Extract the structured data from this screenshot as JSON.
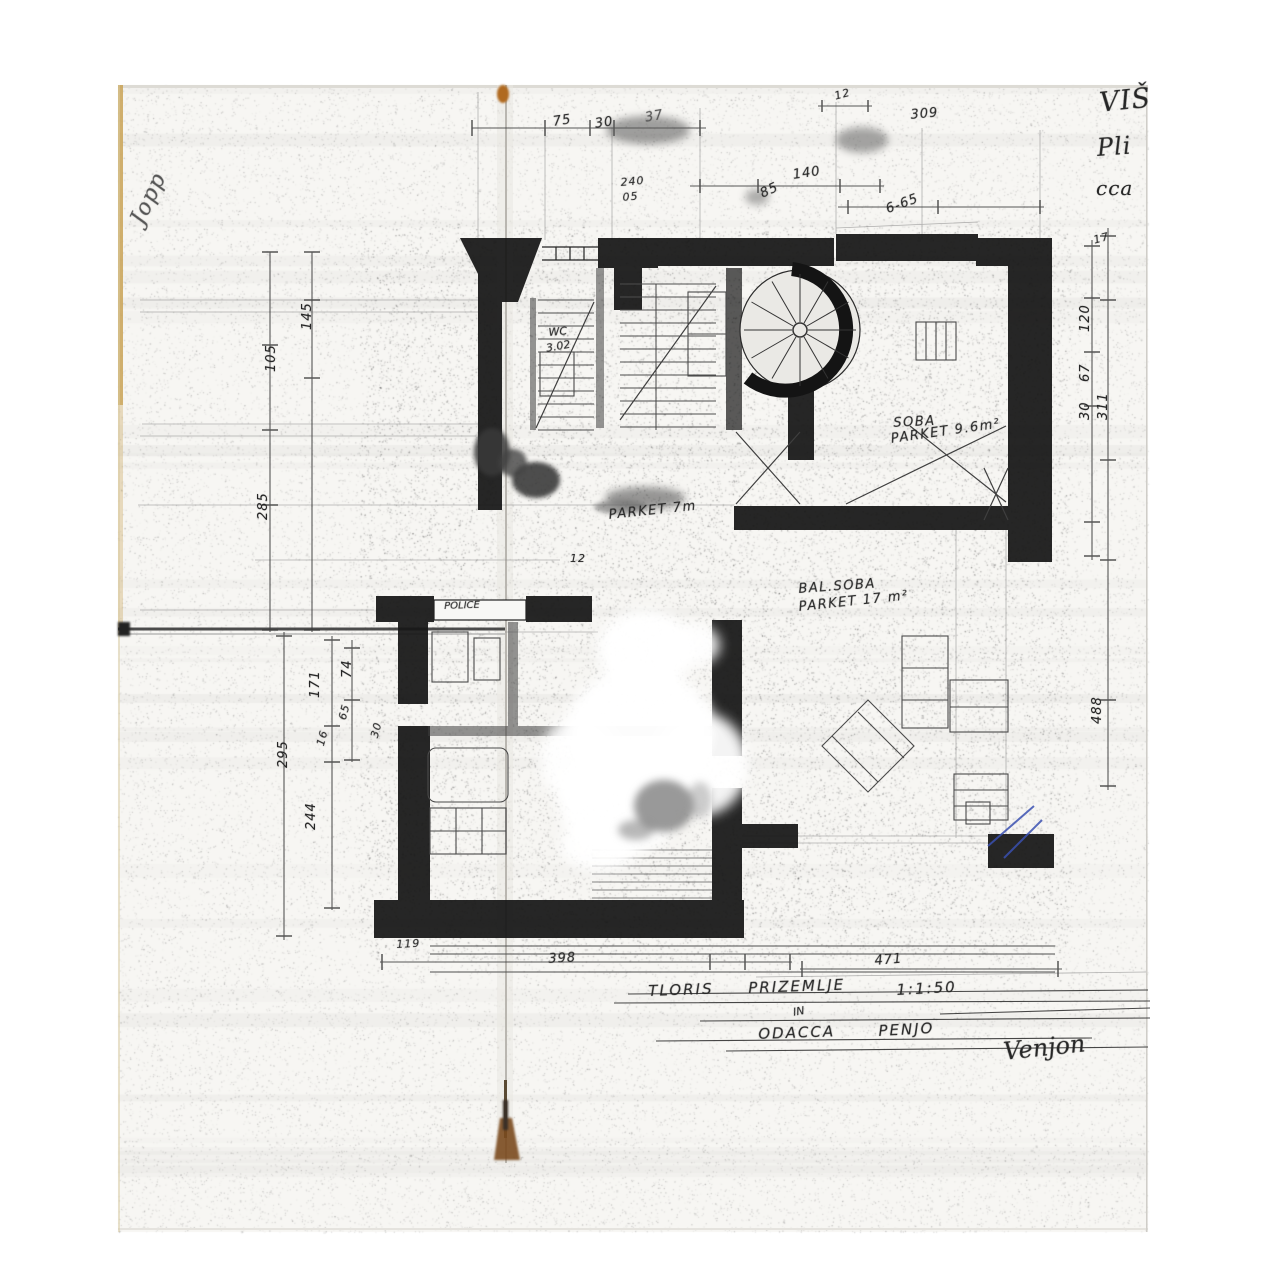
{
  "scan": {
    "margin_notes_top_right": [
      "VIŠ",
      "Pli",
      "cca"
    ],
    "margin_scribble_left": "Jopp",
    "footer": {
      "line1": [
        "TLORIS",
        "PRIZEMLJE",
        "1:1:50"
      ],
      "interline": "IN",
      "line2": [
        "ODACCA",
        "PENJO"
      ],
      "signature": "Venjon"
    }
  },
  "rooms": {
    "soba": {
      "name": "SOBA",
      "area": "PARKET 9.6m²"
    },
    "hall": {
      "floor": "PARKET 7m"
    },
    "bal_soba": {
      "name": "BAL.SOBA",
      "area": "PARKET 17 m²"
    },
    "wc": {
      "name": "WC",
      "area": "3.02"
    },
    "niche": {
      "name": "POLICE"
    }
  },
  "dimensions": {
    "top": [
      "75",
      "30",
      "37",
      "12",
      "309",
      "140",
      "85",
      "240",
      "05",
      "6-65"
    ],
    "left": [
      "145",
      "105",
      "285",
      "295",
      "171",
      "74",
      "65",
      "16",
      "30",
      "244"
    ],
    "right": [
      "17",
      "120",
      "67",
      "30",
      "311",
      "488"
    ],
    "bottom": [
      "119",
      "398",
      "471"
    ],
    "center": [
      "12"
    ]
  },
  "colors": {
    "paper": "#f7f6f3",
    "ink": "#161616",
    "pencil": "#4a4a4a",
    "stain": "#8a5a26",
    "blue_pen": "#3a50b0"
  }
}
